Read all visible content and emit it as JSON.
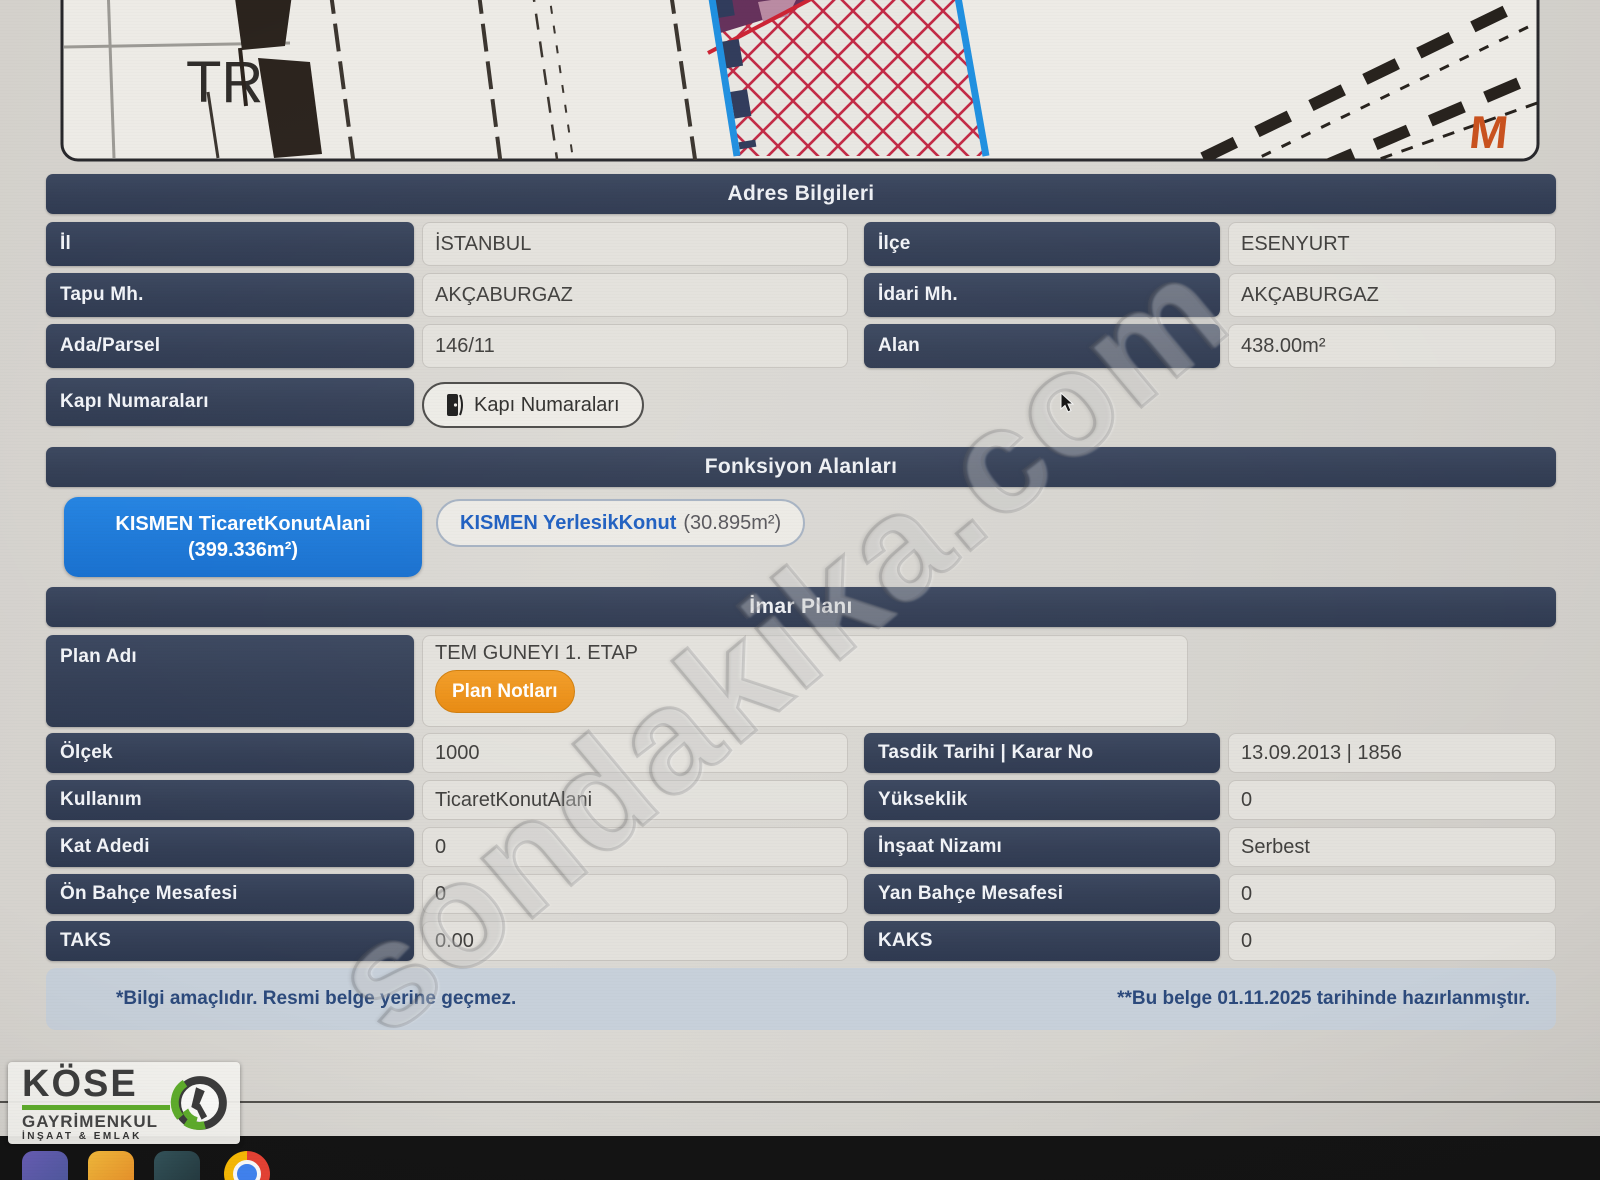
{
  "map": {
    "tr_label": "TR",
    "m_logo": "M"
  },
  "adres": {
    "title": "Adres Bilgileri",
    "rows_left": [
      {
        "label": "İl",
        "value": "İSTANBUL"
      },
      {
        "label": "Tapu Mh.",
        "value": "AKÇABURGAZ"
      },
      {
        "label": "Ada/Parsel",
        "value": "146/11"
      }
    ],
    "rows_right": [
      {
        "label": "İlçe",
        "value": "ESENYURT"
      },
      {
        "label": "İdari Mh.",
        "value": "AKÇABURGAZ"
      },
      {
        "label": "Alan",
        "value": "438.00m²"
      }
    ],
    "kapi_label": "Kapı Numaraları",
    "kapi_button": "Kapı Numaraları"
  },
  "fonksiyon": {
    "title": "Fonksiyon Alanları",
    "buttons": [
      {
        "label": "KISMEN TicaretKonutAlani",
        "area": "(399.336m²)",
        "selected": true
      },
      {
        "label": "KISMEN YerlesikKonut",
        "area": "(30.895m²)",
        "selected": false
      }
    ]
  },
  "imar": {
    "title": "İmar Planı",
    "plan_adi_label": "Plan Adı",
    "plan_adi_value": "TEM GUNEYI 1. ETAP",
    "plan_notlari_button": "Plan Notları",
    "rows_left": [
      {
        "label": "Ölçek",
        "value": "1000"
      },
      {
        "label": "Kullanım",
        "value": "TicaretKonutAlani"
      },
      {
        "label": "Kat Adedi",
        "value": "0"
      },
      {
        "label": "Ön Bahçe Mesafesi",
        "value": "0"
      },
      {
        "label": "TAKS",
        "value": "0.00"
      }
    ],
    "rows_right": [
      {
        "label": "Tasdik Tarihi | Karar No",
        "value": "13.09.2013 | 1856"
      },
      {
        "label": "Yükseklik",
        "value": "0"
      },
      {
        "label": "İnşaat Nizamı",
        "value": "Serbest"
      },
      {
        "label": "Yan Bahçe Mesafesi",
        "value": "0"
      },
      {
        "label": "KAKS",
        "value": "0"
      }
    ]
  },
  "footer": {
    "left_note": "*Bilgi amaçlıdır. Resmi belge yerine geçmez.",
    "right_note": "**Bu belge 01.11.2025 tarihinde hazırlanmıştır."
  },
  "watermark": "sondakika.com",
  "logo": {
    "name": "KÖSE",
    "line2": "GAYRİMENKUL",
    "line3": "İNŞAAT & EMLAK"
  },
  "colors": {
    "header_navy": "#333e55",
    "accent_blue": "#1c77d9",
    "accent_orange": "#ef9318",
    "footer_bg": "#c7d0da",
    "footer_text": "#2c4a7c",
    "hatch_red": "#c22844",
    "parcel_blue": "#1e8fe0",
    "logo_green": "#5fae2c"
  }
}
